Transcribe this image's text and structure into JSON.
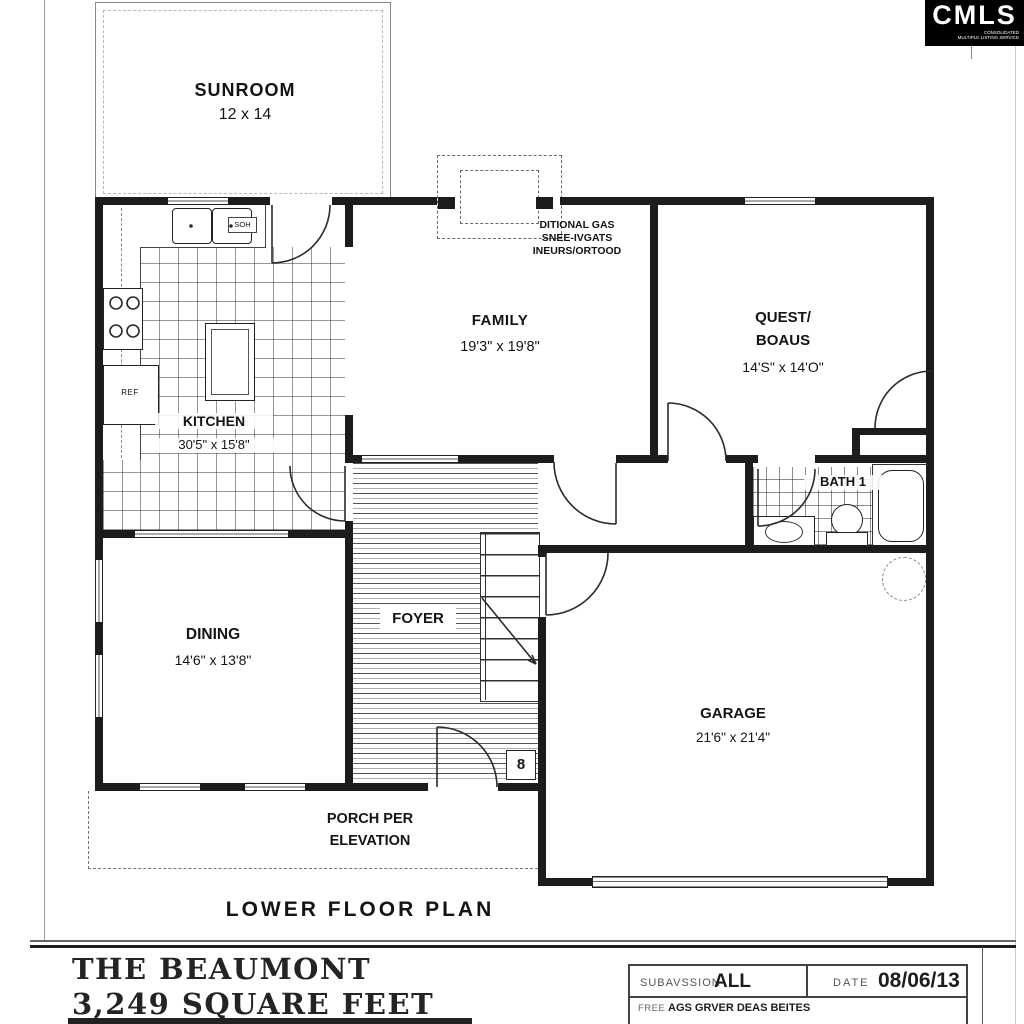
{
  "logo": {
    "name": "CMLS",
    "tagline_line1": "CONSOLIDATED",
    "tagline_line2": "MULTIPLE LISTING SERVICE"
  },
  "rooms": {
    "sunroom": {
      "name": "SUNROOM",
      "dims": "12 x 14"
    },
    "family": {
      "name": "FAMILY",
      "dims": "19'3\" x 19'8\""
    },
    "guest": {
      "name_line1": "QUEST/",
      "name_line2": "BOAUS",
      "dims": "14'S\" x 14'O\""
    },
    "kitchen": {
      "name": "KITCHEN",
      "dims": "30'5\" x 15'8\""
    },
    "bath": {
      "name": "BATH 1"
    },
    "dining": {
      "name": "DINING",
      "dims": "14'6\" x 13'8\""
    },
    "foyer": {
      "name": "FOYER"
    },
    "garage": {
      "name": "GARAGE",
      "dims": "21'6\" x 21'4\""
    },
    "porch": {
      "name_line1": "PORCH PER",
      "name_line2": "ELEVATION"
    }
  },
  "annotations": {
    "gas_note_line1": "DITIONAL GAS",
    "gas_note_line2": "SNEE-IVGATS",
    "gas_note_line3": "INEURS/ORTOOD",
    "counter_label": "SOH",
    "fridge_label": "REF",
    "stair_landing": "8"
  },
  "plan_title": "LOWER FLOOR PLAN",
  "footer": {
    "model_name": "THE BEAUMONT",
    "square_feet": "3,249 SQUARE FEET",
    "subdivision_label": "SUBAVSSION",
    "subdivision_value": "ALL",
    "date_label": "DATE",
    "date_value": "08/06/13",
    "area_label": "FREE",
    "area_value": "AGS GRVER DEAS BEITES"
  },
  "colors": {
    "ink": "#1c1c1c",
    "paper": "#ffffff"
  }
}
